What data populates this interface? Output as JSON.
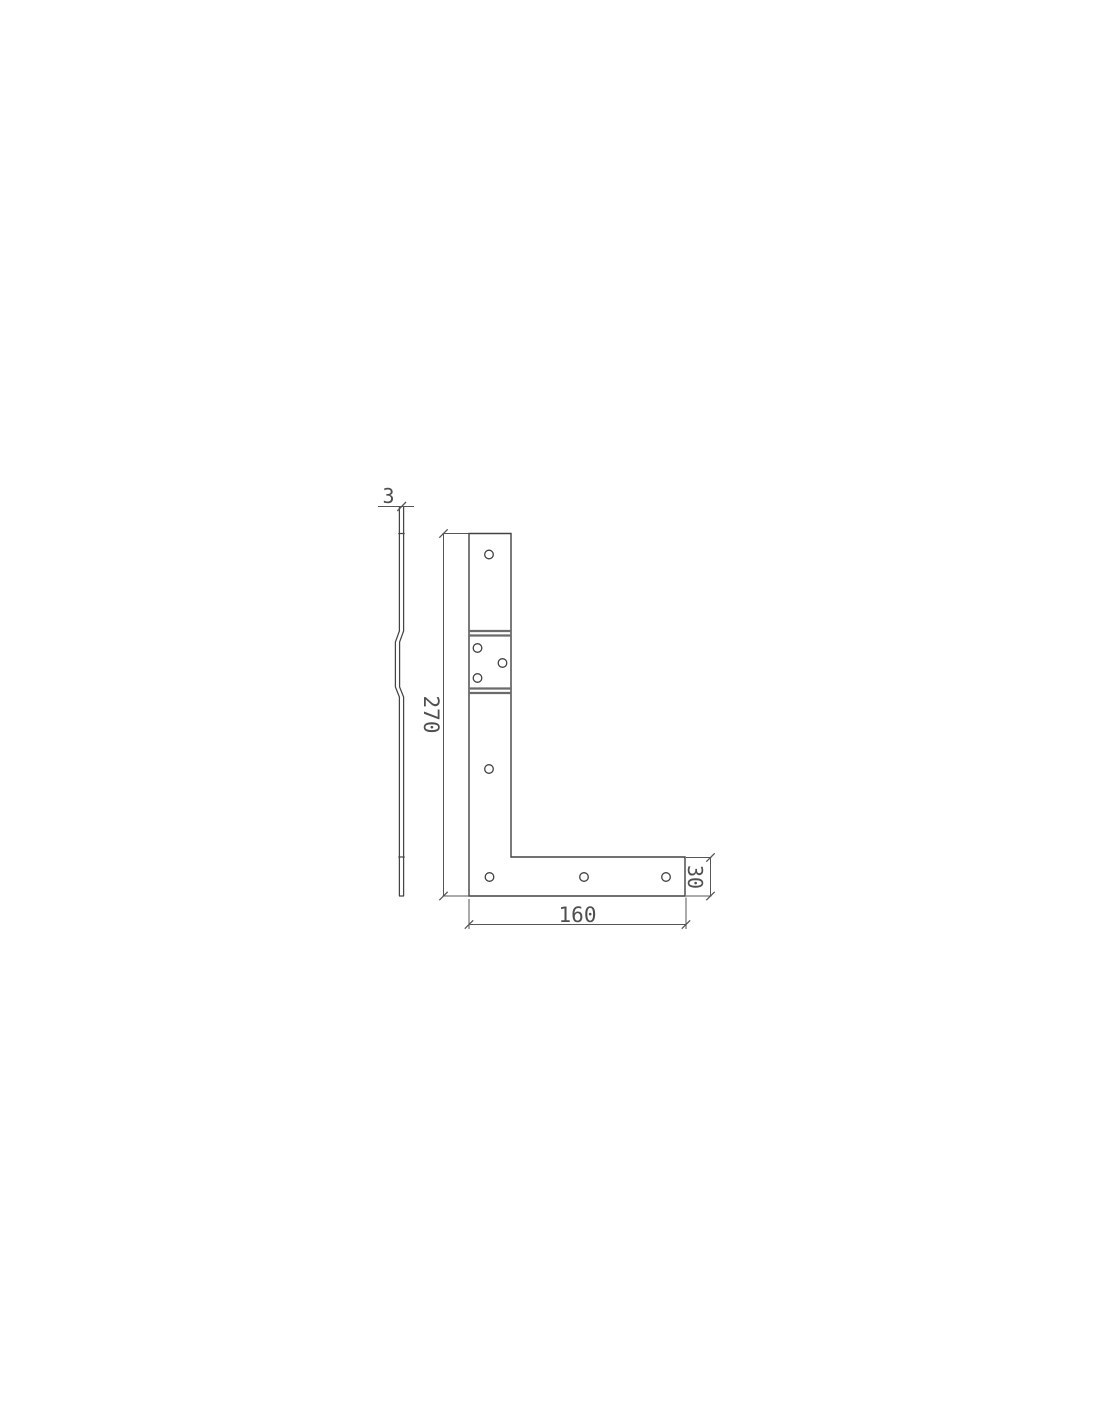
{
  "drawing": {
    "description": "Technical drawing of an L-shaped flat corner bracket with joggled (offset) section, shown in side profile view and front view",
    "views": {
      "side": "side profile with joggle offset",
      "front": "L-shaped front elevation"
    },
    "dimensions": {
      "thickness": "3",
      "height": "270",
      "length": "160",
      "width": "30"
    },
    "holes": {
      "count": 8
    },
    "colors": {
      "background": "#ffffff",
      "outline": "#424242",
      "bend_line": "#6b6b6b",
      "dimension_line": "#565656",
      "text": "#4f4f4f"
    }
  }
}
